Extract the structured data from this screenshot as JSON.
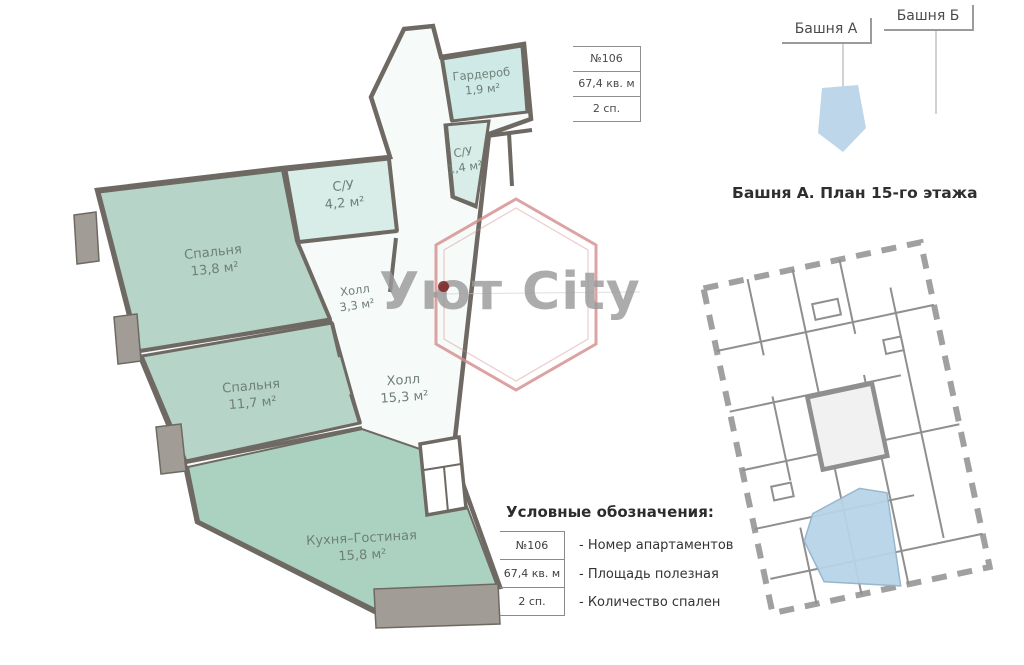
{
  "tabs": {
    "tower_a": "Башня А",
    "tower_b": "Башня Б"
  },
  "info_box": {
    "apartment_number": "№106",
    "area": "67,4 кв. м",
    "bedrooms": "2 сп."
  },
  "apartment_plan": {
    "rooms": [
      {
        "name": "Гардероб",
        "area": "1,9 м²"
      },
      {
        "name": "С/У",
        "area": "1,4 м²"
      },
      {
        "name": "С/У",
        "area": "4,2 м²"
      },
      {
        "name": "Спальня",
        "area": "13,8 м²"
      },
      {
        "name": "Холл",
        "area": "3,3 м²"
      },
      {
        "name": "Холл",
        "area": "15,3 м²"
      },
      {
        "name": "Спальня",
        "area": "11,7 м²"
      },
      {
        "name": "Кухня–Гостиная",
        "area": "15,8 м²"
      }
    ]
  },
  "watermark": {
    "text": "Уют City"
  },
  "tower_plan": {
    "title": "Башня А. План 15-го этажа"
  },
  "legend": {
    "title": "Условные обозначения:",
    "rows": [
      {
        "key": "№106",
        "description": "- Номер апартаментов"
      },
      {
        "key": "67,4 кв. м",
        "description": "- Площадь полезная"
      },
      {
        "key": "2 сп.",
        "description": "- Количество спален"
      }
    ]
  },
  "colors": {
    "bedroom_fill": "#b6d4c7",
    "kitchen_fill": "#abd2c0",
    "bathroom_fill": "#d8ede7",
    "wardrobe_fill": "#cfeae6",
    "hall_fill": "#f6faf8",
    "wall": "#6e6963",
    "pier_fill": "#a29c96",
    "watermark_pink": "#d48c8c",
    "watermark_gray": "#9a9a9a",
    "highlight_blue": "#b9d4e8"
  }
}
